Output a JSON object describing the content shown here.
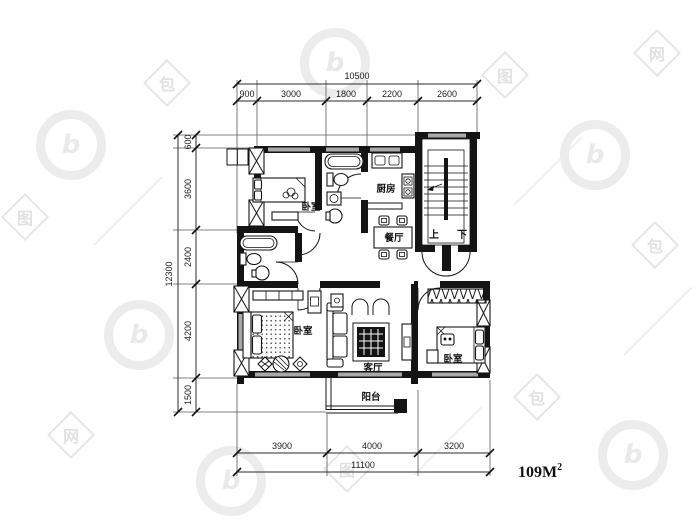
{
  "title": "apartment-floor-plan",
  "area": {
    "base": "109M",
    "sup": "2"
  },
  "dims": {
    "top": {
      "total": "10500",
      "segments": [
        "900",
        "3000",
        "1800",
        "2200",
        "2600"
      ]
    },
    "left": {
      "total": "12300",
      "segments": [
        "600",
        "3600",
        "2400",
        "4200",
        "1500"
      ]
    },
    "bottom": {
      "total": "11100",
      "segments": [
        "3900",
        "4000",
        "3200"
      ]
    }
  },
  "rooms": {
    "bedroom_top": "卧室",
    "kitchen": "厨房",
    "dining": "餐厅",
    "living": "客厅",
    "bedroom_master": "卧室",
    "bedroom_right": "卧室",
    "balcony": "阳台"
  },
  "stairs": {
    "up": "上",
    "down": "下"
  },
  "colors": {
    "wall": "#141414",
    "window": "#a9a9a9",
    "watermark": "#e8e8e8",
    "background": "#ffffff"
  },
  "watermark": {
    "char1": "包",
    "char2": "图",
    "char3": "网",
    "brand_letter": "b"
  }
}
